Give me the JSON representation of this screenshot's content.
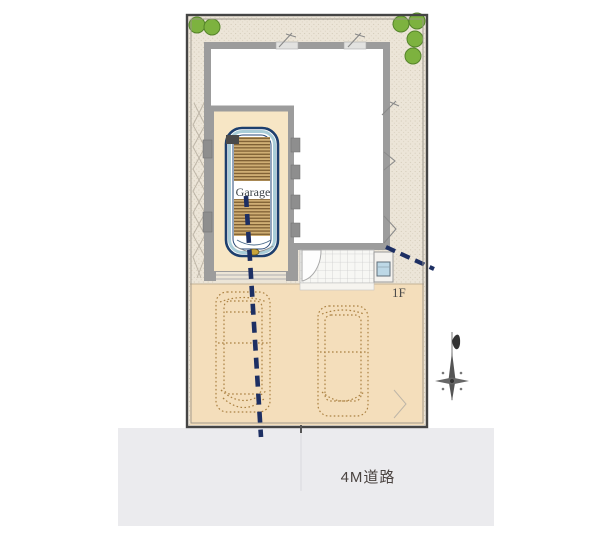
{
  "plan": {
    "garage_label": "Garage",
    "floor_label": "1F",
    "road_label": "4M道路"
  },
  "icons": {
    "trees": "tree-canopy-circle",
    "compass": "compass-north-arrow",
    "door": "door-swing-arc",
    "meter": "utility-meter-box"
  },
  "colors": {
    "site_background": "#ece5d8",
    "site_boundary": "#454545",
    "wall_gray": "#9c9c9c",
    "building_floor": "#ffffff",
    "garage_floor": "#f7e6c5",
    "parking_surface": "#f4debb",
    "car_outline_navy": "#1d3f6e",
    "car_accent_blue": "#a9cdd8",
    "shutter_base": "#cfae74",
    "shutter_stripe": "#7e5f33",
    "driveway_dash_navy": "#1d2f63",
    "dotted_car_tan": "#ab8142",
    "tree_green": "#7db23f",
    "road_surface": "#ebebee",
    "tile_line": "#cdcdcd",
    "meter_blue": "#bdd8e6",
    "label_color": "#4a4340"
  }
}
